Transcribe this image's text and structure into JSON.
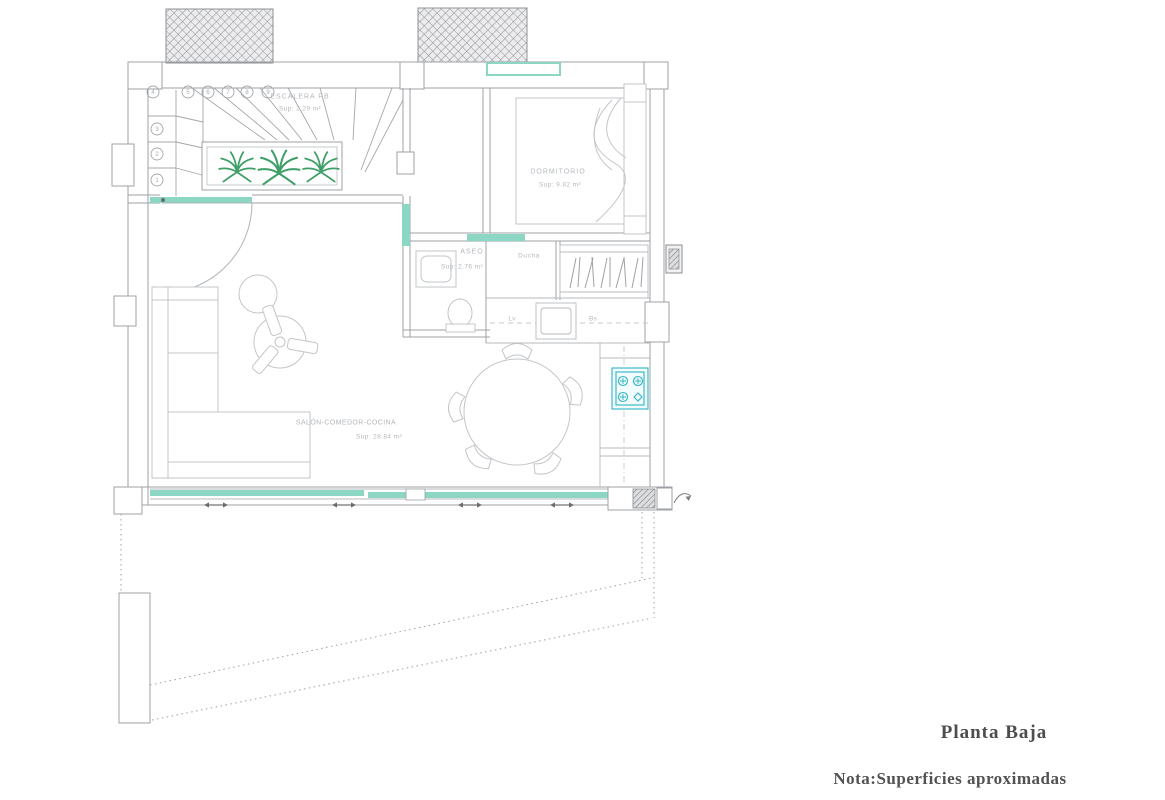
{
  "drawing": {
    "title": "Planta Baja",
    "note": "Nota:Superficies aproximadas"
  },
  "rooms": {
    "escalera": {
      "label": "ESCALERA PB",
      "area": "Sup: 2.29 m²"
    },
    "dormitorio": {
      "label": "DORMITORIO",
      "area": "Sup: 9.82 m²"
    },
    "aseo": {
      "label": "ASEO",
      "area": "Sup: 2.76 m²"
    },
    "ducha": {
      "label": "Ducha"
    },
    "salon": {
      "label": "SALÓN-COMEDOR-COCINA",
      "area": "Sup: 28.84 m²"
    }
  },
  "kitchen": {
    "lv_label": "Lv",
    "bs_label": "Bs"
  },
  "stairs": {
    "steps": [
      "1",
      "2",
      "3",
      "4",
      "5",
      "6",
      "7",
      "8",
      "9"
    ]
  },
  "colors": {
    "glazing_teal": "#8bd7c3",
    "stove_cyan": "#2fb3c4",
    "plant_green": "#3f9f68",
    "wall_gray": "#9da1a6",
    "furniture_gray": "#c2c5c9",
    "label_gray": "#b3b7bc",
    "text_dark": "#4d4d4d"
  }
}
